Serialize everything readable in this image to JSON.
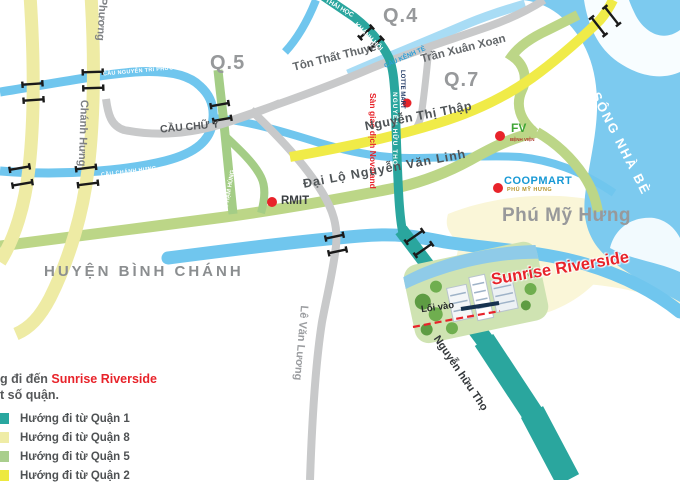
{
  "map": {
    "districts": {
      "q4": "Q.4",
      "q5": "Q.5",
      "q7": "Q.7"
    },
    "areas": {
      "binh_chanh": "HUYỆN BÌNH CHÁNH",
      "phu_my_hung": "Phú Mỹ Hưng",
      "river": "SÔNG NHÀ BÈ"
    },
    "roads": {
      "ton_that_thuyet": "Tôn Thất Thuyết",
      "tran_xuan_xoan": "Trần Xuân Xoạn",
      "thai_hoc": "THÁI HỌC",
      "khanh_hoi": "KHÁNH HỘI",
      "nguyen_huu_tho": "NGUYỄN HỮU THỌ",
      "nguyen_huu_tho_lower": "Nguyễn hữu Thọ",
      "nguyen_thi_thap": "Nguyễn Thị Thập",
      "nguyen_van_linh": "Đại Lộ Nguyễn Văn Linh",
      "le_van_luong": "Lê Văn Lương",
      "chanh_hung": "Chánh Hưng",
      "phuong": "Phương",
      "pham_hung": "PHẠM HÙNG"
    },
    "bridges": {
      "cau_nguyen_tri_phuong": "CẦU NGUYỄN TRI PHƯƠNG",
      "cau_chanh_hung": "CẦU CHÁNH HƯNG",
      "cau_chu_y": "CẦU CHỮ Y",
      "cau_kenh_te": "CẦU KÊNH TẺ"
    },
    "pois": {
      "rmit": "RMIT",
      "lotte_mart": "LOTTE MART",
      "novaland": "Sàn giao dịch Novaland",
      "fv": "FV",
      "fv_sub": "BỆNH VIỆN",
      "coopmart": "COOPMART",
      "coopmart_sub": "PHÚ MỸ HƯNG",
      "sunrise": "Sunrise Riverside",
      "loi_vao": "Lối vào"
    }
  },
  "legend": {
    "title_prefix": "g đi đến ",
    "title_highlight": "Sunrise Riverside",
    "title_line2": "t số quận.",
    "items": [
      {
        "label": "Hướng đi từ Quận 1",
        "color": "#29A79F"
      },
      {
        "label": "Hướng đi từ Quận 8",
        "color": "#EFECA6"
      },
      {
        "label": "Hướng đi từ Quận 5",
        "color": "#A9CE8D"
      },
      {
        "label": "Hướng đi từ Quận 2",
        "color": "#EDE93F"
      }
    ]
  },
  "colors": {
    "route_q1_teal": "#2AA69E",
    "route_q8_pale_yellow": "#EEEBA4",
    "route_q5_green": "#A4CD86",
    "route_q2_yellow": "#F0EB48",
    "water": "#70C6EE",
    "accent_red": "#E8232A"
  }
}
